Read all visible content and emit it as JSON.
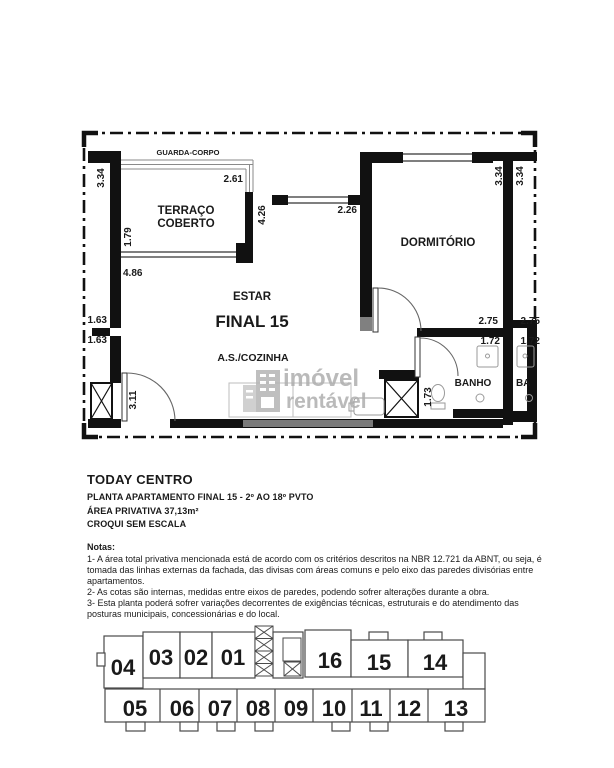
{
  "colors": {
    "wall": "#111111",
    "unit_highlight": "#a9a9a9",
    "watermark_primary": "#aeaeae",
    "watermark_secondary": "#c6c6c6"
  },
  "floor_plan": {
    "guard_rail_label": "GUARDA-CORPO",
    "rooms": {
      "terrace_line1": "TERRAÇO",
      "terrace_line2": "COBERTO",
      "living": "ESTAR",
      "unit_label": "FINAL 15",
      "kitchen": "A.S./COZINHA",
      "bedroom": "DORMITÓRIO",
      "bathroom": "BANHO",
      "neighbor_bathroom": "BA"
    },
    "dimensions": {
      "terrace_side": "3.34",
      "terrace_width": "2.61",
      "terrace_depth": "1.79",
      "living_width": "4.86",
      "living_depth": "4.26",
      "living_window": "2.26",
      "bedroom_side": "3.34",
      "neighbor_side": "3.34",
      "recess_upper": "1.63",
      "recess_lower": "1.63",
      "entry": "3.11",
      "bathroom_width": "2.75",
      "bathroom_fixture": "1.72",
      "bathroom_depth": "1.73",
      "neighbor_bathroom_width": "2.75",
      "neighbor_bathroom_fixture": "1.72"
    },
    "watermark": {
      "word1": "imóvel",
      "word2": "rentável"
    }
  },
  "document": {
    "project_name": "TODAY CENTRO",
    "plan_line": "PLANTA APARTAMENTO FINAL 15 - 2º AO 18º PVTO",
    "area_line": "ÁREA PRIVATIVA 37,13m²",
    "scale_line": "CROQUI SEM ESCALA",
    "notes_title": "Notas:",
    "note1": "1- A área total privativa mencionada está de acordo com os critérios descritos na NBR 12.721 da ABNT, ou seja, é tomada das linhas externas da fachada, das divisas com áreas comuns e pelo eixo das paredes divisórias entre apartamentos.",
    "note2": "2- As cotas são internas, medidas entre eixos de paredes, podendo sofrer alterações durante a obra.",
    "note3": "3- Esta planta poderá sofrer variações decorrentes de exigências técnicas, estruturais e do atendimento das posturas municipais, concessionárias e do local."
  },
  "key_plan": {
    "highlighted_unit": "15",
    "top_row": [
      "04",
      "03",
      "02",
      "01",
      "16",
      "15",
      "14"
    ],
    "bottom_row": [
      "05",
      "06",
      "07",
      "08",
      "09",
      "10",
      "11",
      "12",
      "13"
    ]
  }
}
